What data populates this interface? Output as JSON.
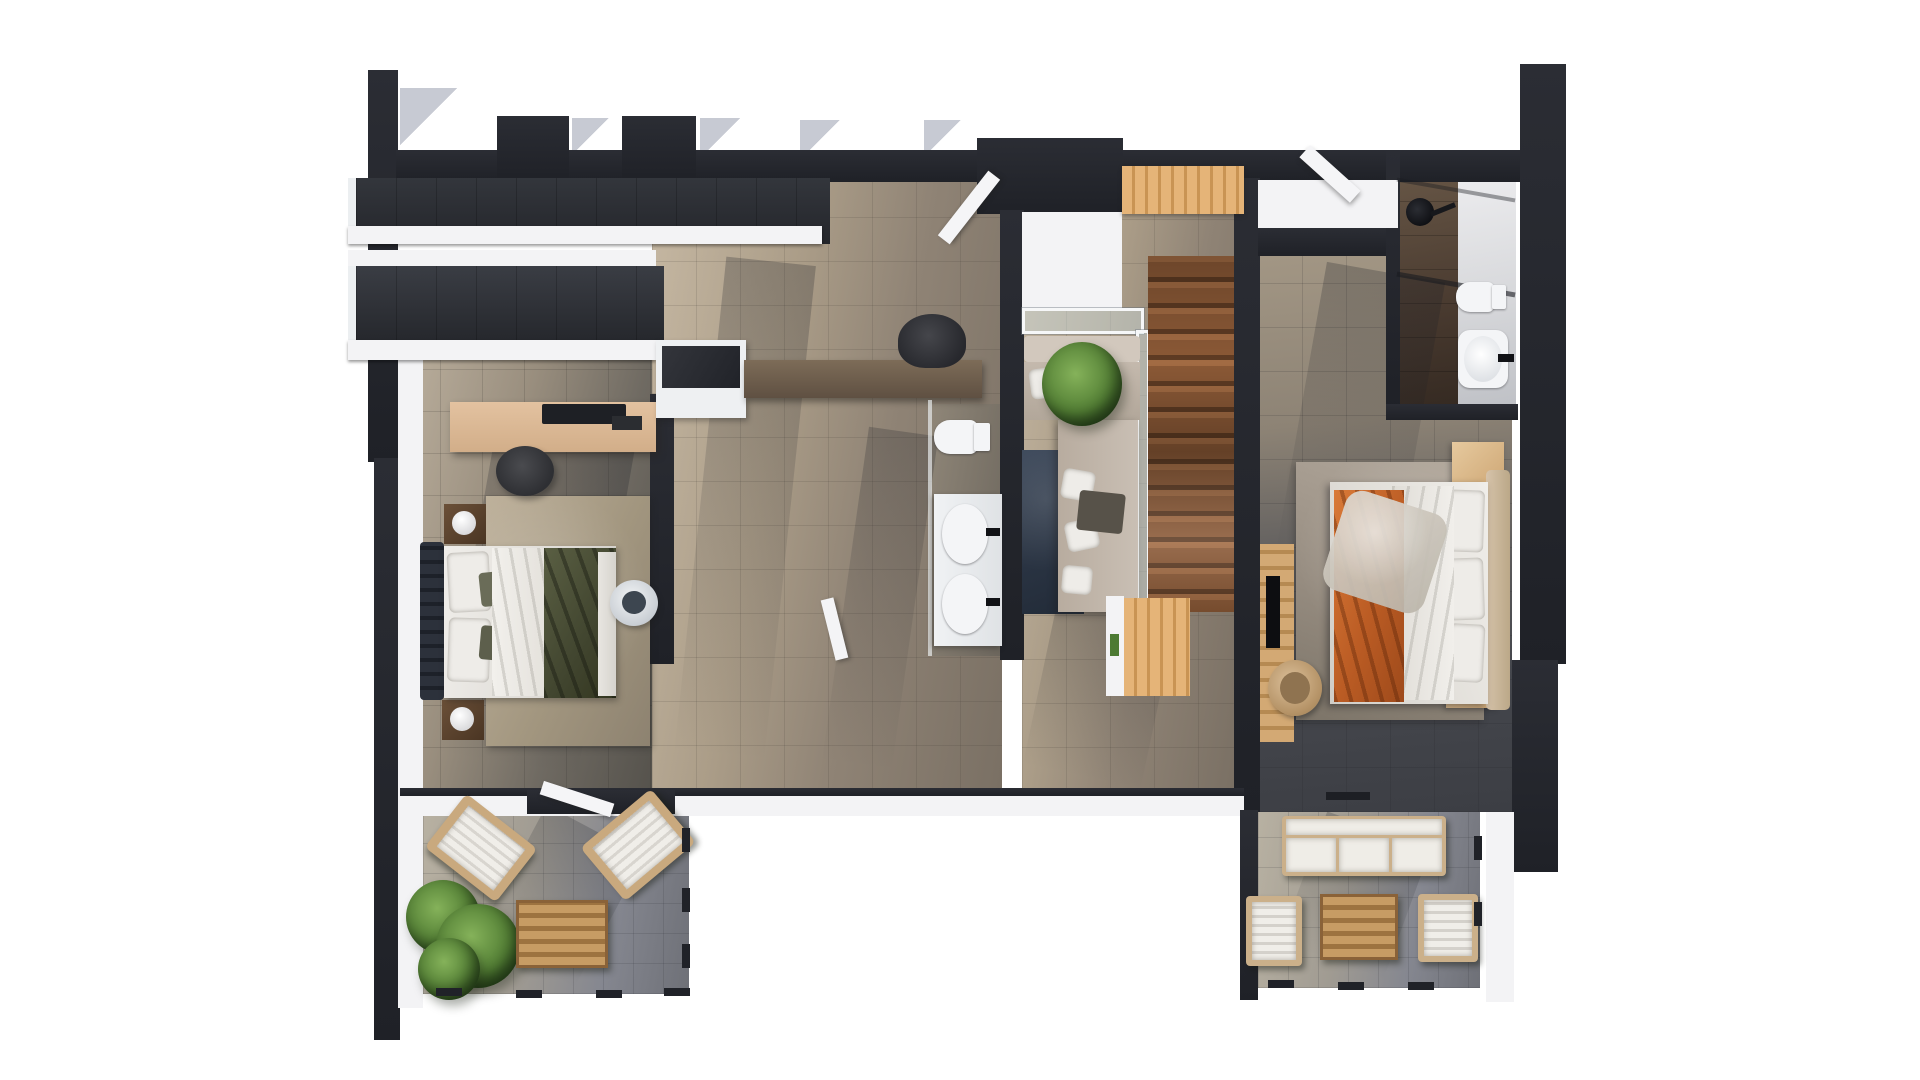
{
  "scene": {
    "type": "3d-floor-plan-render",
    "view": "top-down cutaway of upper storey",
    "background": "#ffffff",
    "visible_text": "none"
  },
  "palette": {
    "wall_dark": "#26282e",
    "wall_white": "#f3f3f5",
    "floor_beige": "#a89a86",
    "floor_gray": "#6f6a62",
    "terrace_tile": "#8a8c92",
    "stair_wood": "#8b5936",
    "light_wood": "#d9a967",
    "desk_wood": "#dcba97",
    "rug_beige": "#b3a791",
    "rug_navy": "#2e3947",
    "rug_gray": "#a49a8e",
    "blanket_green": "#4b5038",
    "blanket_orange": "#c3622a",
    "sofa_beige": "#c6bbb0",
    "plant_green": "#527e34",
    "fixture_white": "#f4f5f7"
  },
  "rooms": [
    {
      "id": "bedroom-left",
      "label": "Bedroom 1",
      "furniture": [
        "open wardrobe shelving",
        "long desk with monitor",
        "desk stool",
        "double bed with green throw",
        "two dark nightstands with round lamps",
        "beige area rug",
        "sun hat on floor"
      ]
    },
    {
      "id": "hallway",
      "label": "Hallway / Study Nook",
      "furniture": [
        "white dresser",
        "wall-mounted study counter",
        "office chair"
      ]
    },
    {
      "id": "bathroom-main",
      "label": "Main Bathroom",
      "furniture": [
        "walk-in shower",
        "toilet",
        "double vanity with two basins and black taps"
      ]
    },
    {
      "id": "stair-lounge",
      "label": "Landing Lounge",
      "furniture": [
        "corner sofa with scatter pillows",
        "potted palm",
        "navy rug",
        "glass balustrade"
      ]
    },
    {
      "id": "staircase",
      "label": "Staircase",
      "material": "wood treads, double flight"
    },
    {
      "id": "bedroom-right",
      "label": "Bedroom 2",
      "furniture": [
        "double bed with orange blanket and fur throw",
        "upholstered headboard",
        "two light-wood nightstands",
        "TV panel",
        "rattan armchair",
        "gray area rug"
      ]
    },
    {
      "id": "bathroom-ensuite",
      "label": "En-suite Bathroom",
      "furniture": [
        "rain shower with glass screen",
        "toilet",
        "washbasin with black tap"
      ]
    },
    {
      "id": "terrace-left",
      "label": "Terrace 1",
      "furniture": [
        "two angled lounge chairs",
        "potted palm",
        "slatted wood coffee table",
        "railing posts"
      ]
    },
    {
      "id": "terrace-right",
      "label": "Terrace 2",
      "furniture": [
        "outdoor sofa with white cushions",
        "two outdoor armchairs",
        "slatted wood coffee table",
        "railing posts"
      ]
    }
  ]
}
